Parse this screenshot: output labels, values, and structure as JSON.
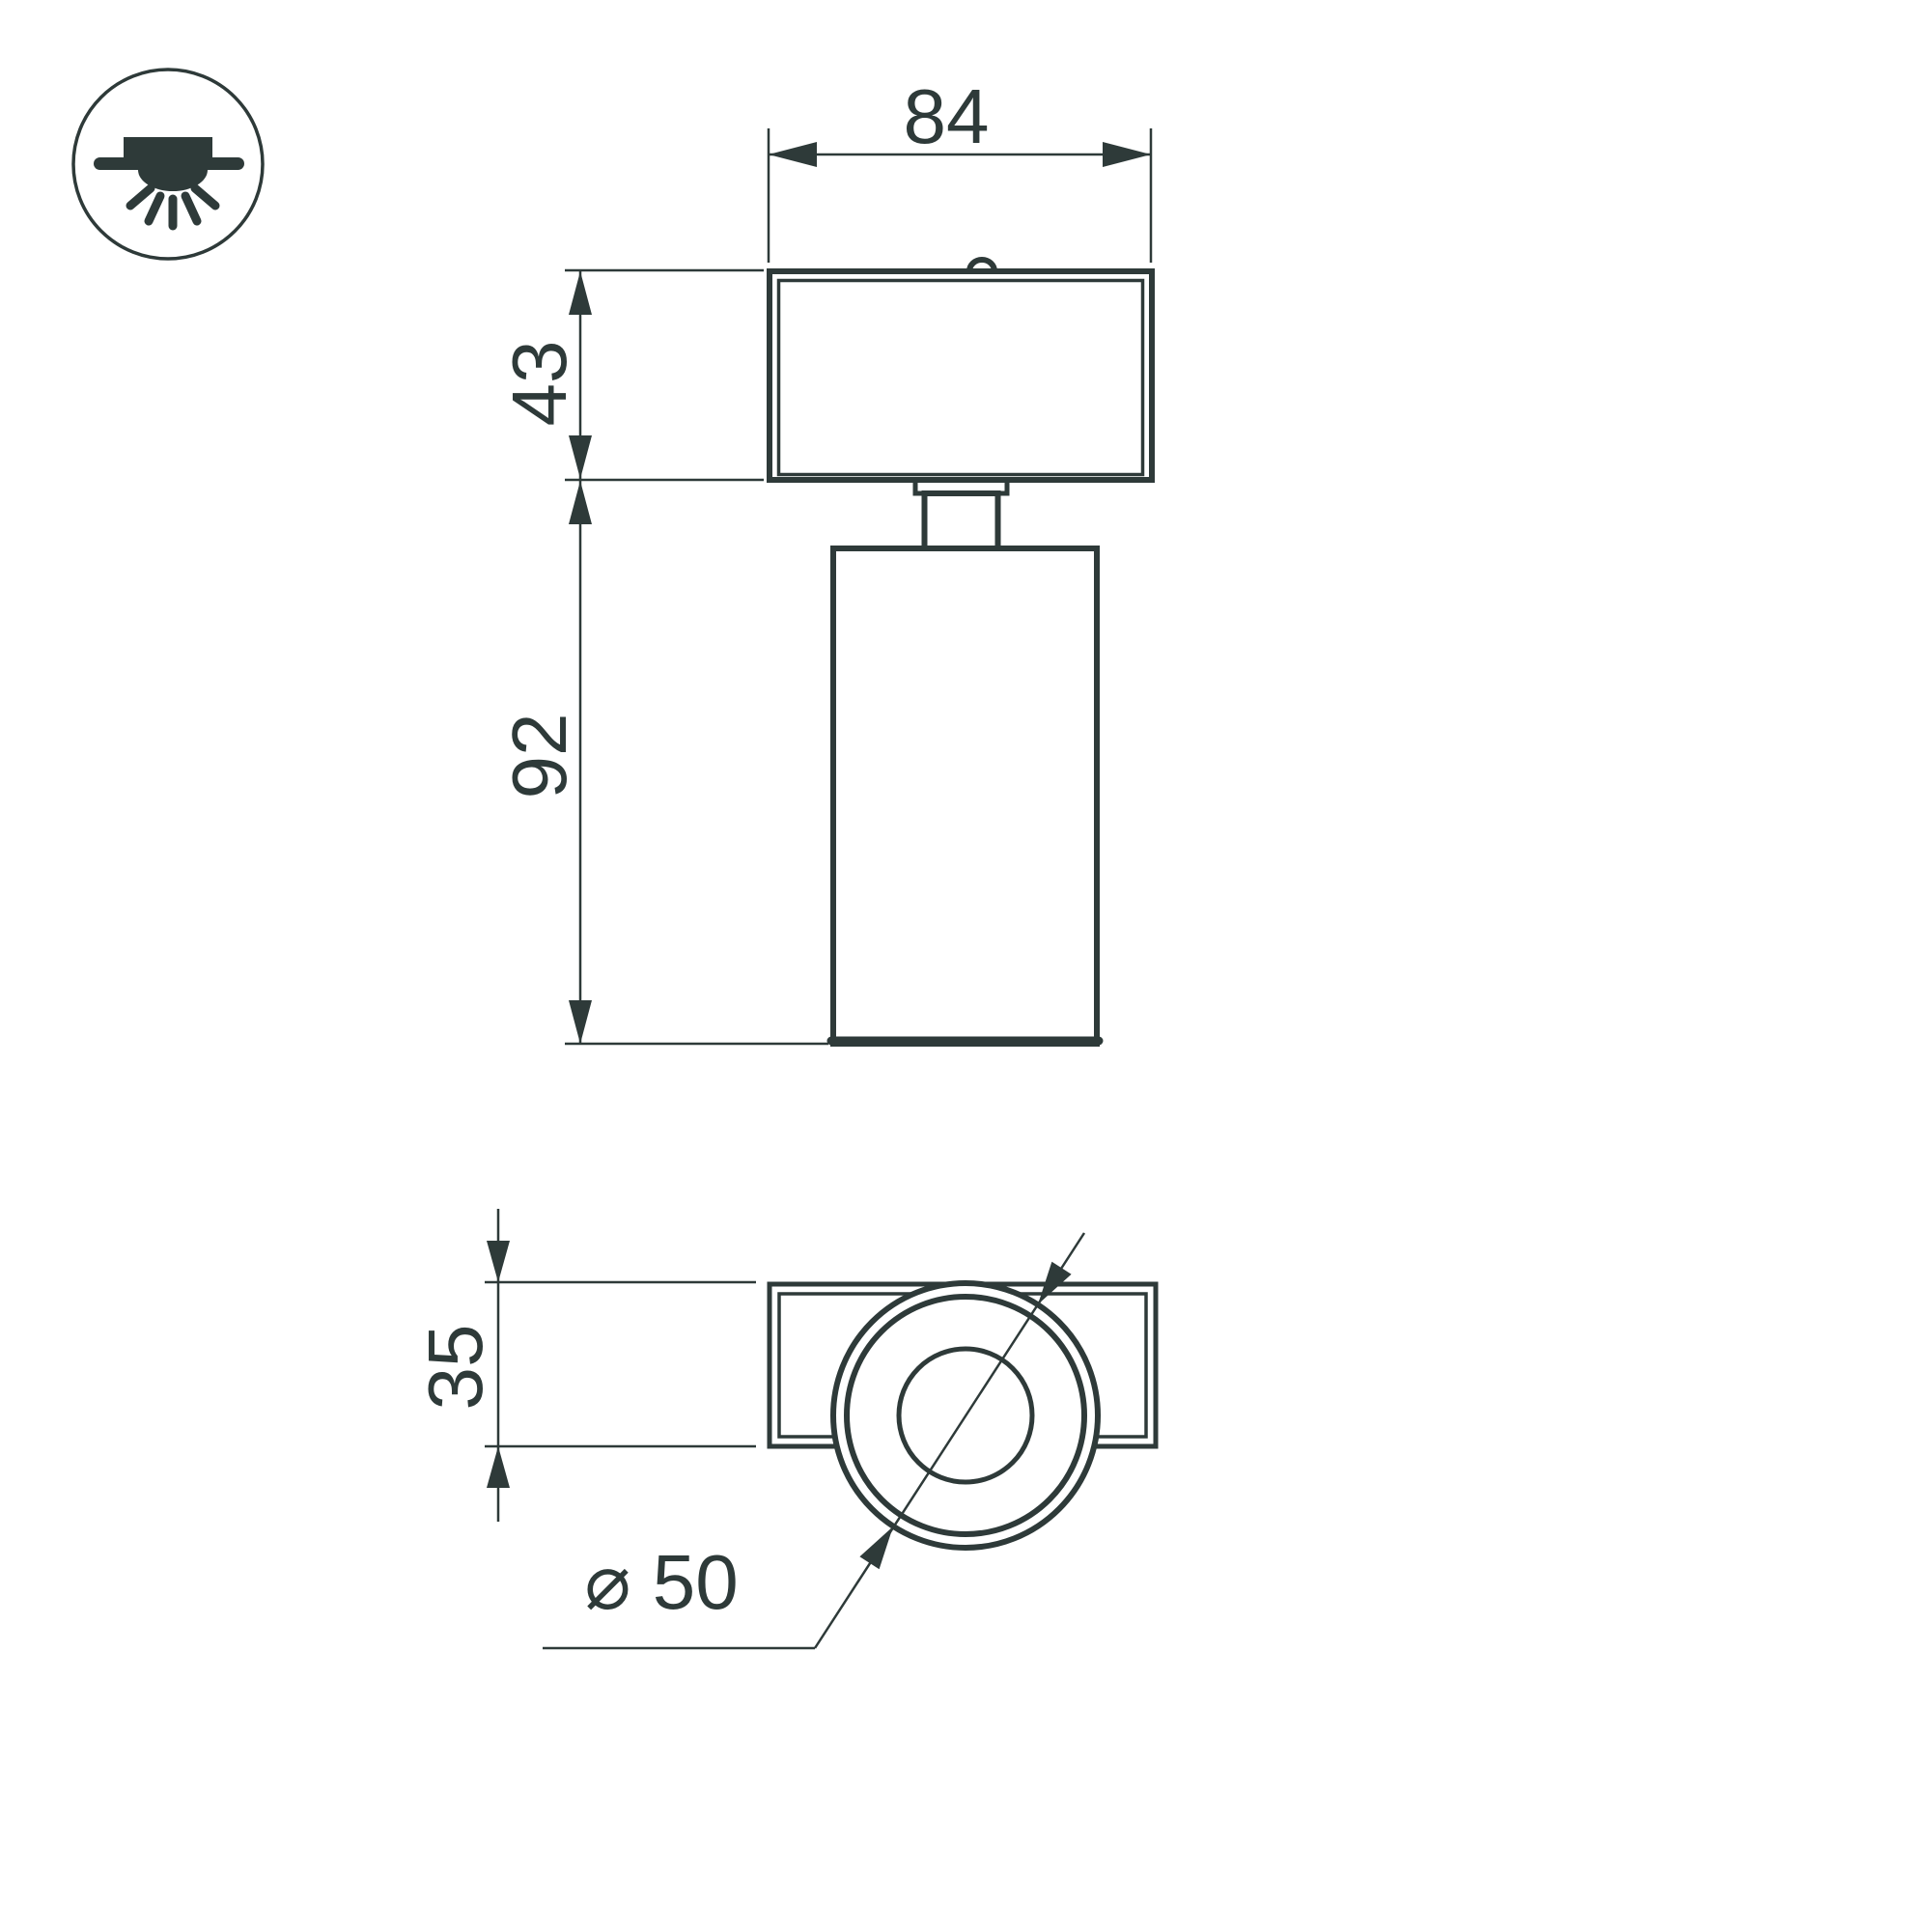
{
  "theme": {
    "background": "#ffffff",
    "ink": "#2e3a39"
  },
  "icon": {
    "name": "surface-mounted-downlight",
    "description": "ceiling surface mount luminaire pictogram"
  },
  "front_view": {
    "dim_width": "84",
    "dim_base_height": "43",
    "dim_body_height": "92"
  },
  "top_view": {
    "dim_base_depth": "35",
    "dim_diameter": "⌀ 50"
  }
}
